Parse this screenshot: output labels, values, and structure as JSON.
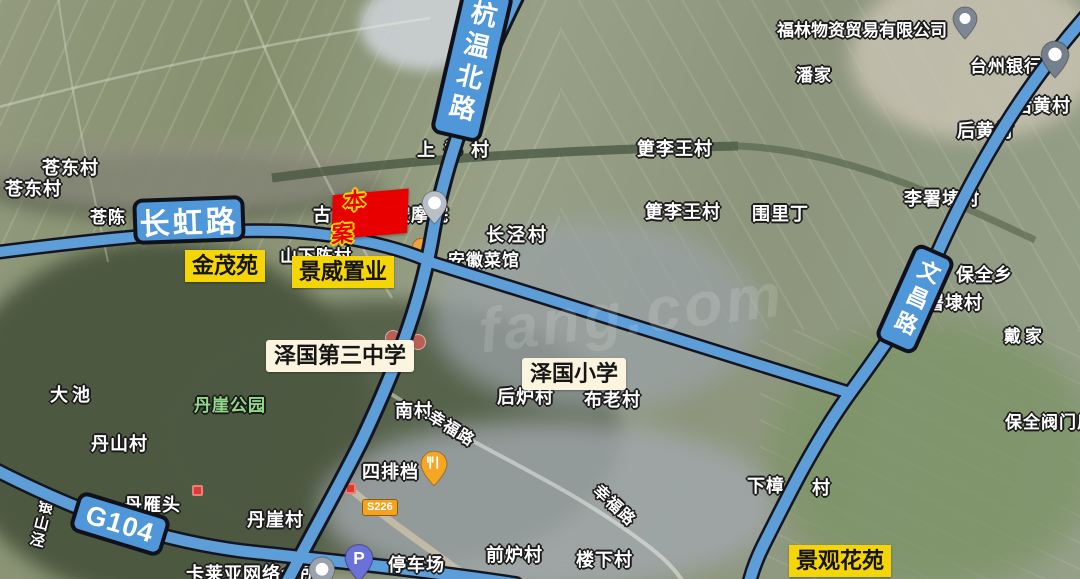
{
  "map": {
    "watermark": "fang.com",
    "site_marker": {
      "label": "本案",
      "fill": "#e80000",
      "text_outline": "#ffd900"
    },
    "road_signs": {
      "changhong": "长虹路",
      "hangwenbei": "杭温北路",
      "wenchang": "文昌路",
      "g104": "G104",
      "s226": "S226"
    },
    "highlight_labels": {
      "jinmao": "金茂苑",
      "jingwei": "景威置业",
      "jingguan": "景观花苑"
    },
    "school_labels": {
      "middle": "泽国第三中学",
      "primary": "泽国小学"
    },
    "street_labels": {
      "xingfu1": "幸福路",
      "xingfu2": "幸福路",
      "yinshanjing": "银山泾"
    },
    "place_labels": {
      "cangdong1": "苍东村",
      "cangdong2": "苍东村",
      "cangchen": "苍陈",
      "shangzheng": "上郑村",
      "gu": "古",
      "anmoyuan": "按摩院",
      "shanxiachen": "山下陈村",
      "changjing": "长泾村",
      "anhui_restaurant": "安徽菜馆",
      "gengliwang1": "筻李王村",
      "gengliwang2": "筻李王村",
      "weiliding": "围里丁",
      "fulin": "福林物资贸易有限公司",
      "panjia": "潘家",
      "taizhou_bank": "台州银行",
      "houhuang1": "后黄村",
      "houhuang2": "后黄村",
      "lishudai": "李署埭村",
      "baoquanxiang": "保全乡",
      "shudai": "署埭村",
      "daijia": "戴家",
      "baoquan_valve": "保全阀门厂",
      "xiazhang": "下樟",
      "xiazhang_cun": "村",
      "nancun": "南村",
      "houlu": "后炉村",
      "bulao": "布老村",
      "qianlu": "前炉村",
      "louxia": "楼下村",
      "dachi": "大池",
      "danya_park": "丹崖公园",
      "danshan": "丹山村",
      "danyantou": "丹雁头",
      "danya_cun": "丹崖村",
      "kalaiya": "卡莱亚网络会所",
      "sipaidang": "四排档",
      "parking_lot": "停车场"
    },
    "poi": {
      "parking_glyph": "P"
    },
    "colors": {
      "road_fill": "#5d9ed8",
      "road_casing": "#15151f",
      "sign_bg": "#4f97d9",
      "highlight_bg": "#f6d506"
    }
  }
}
